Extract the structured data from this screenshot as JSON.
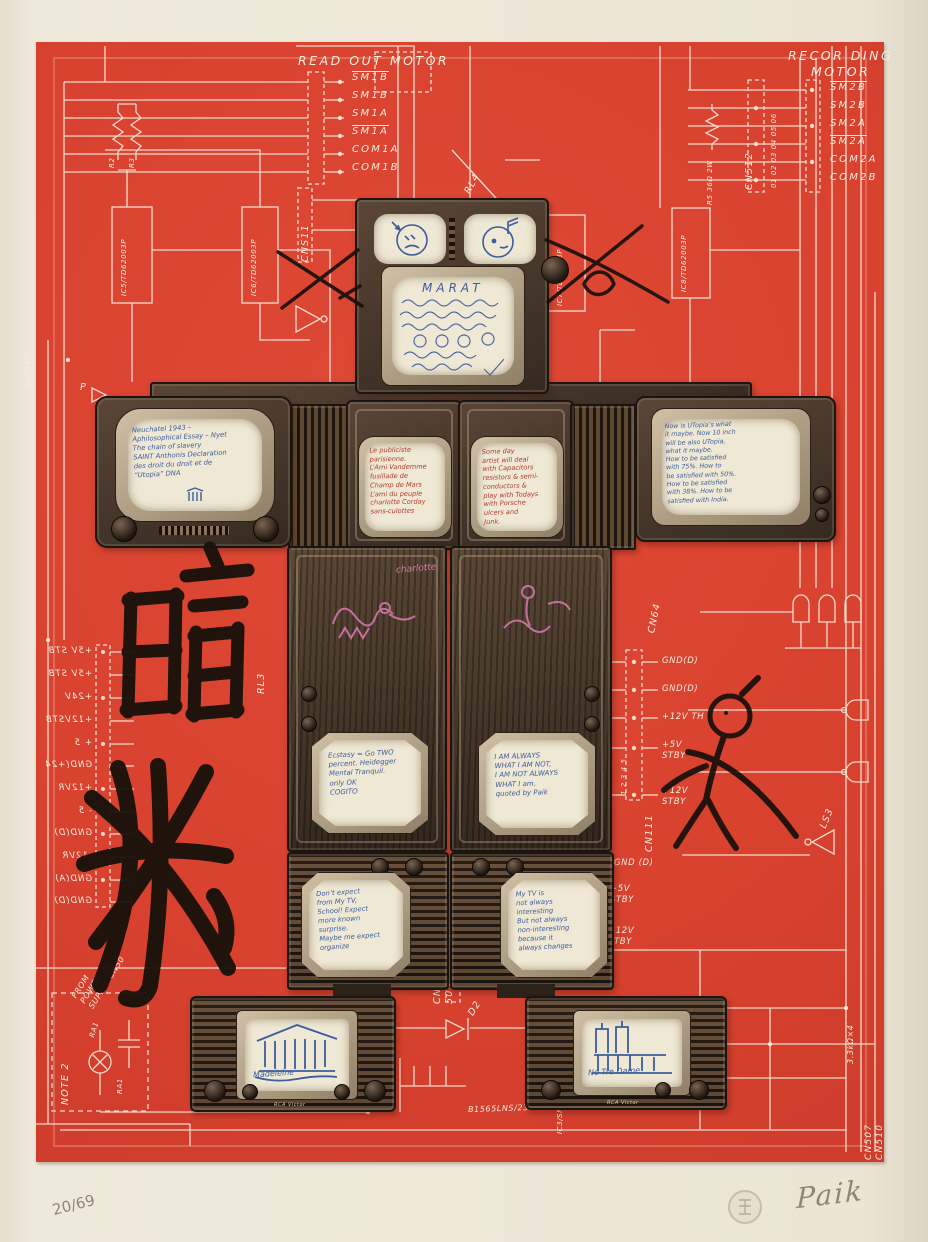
{
  "artwork": {
    "edition_number": "20/69",
    "signature": "Paik",
    "colors": {
      "plate_red": "#d9422f",
      "line_white": "#f6ecdd",
      "ink_blue": "#3d5c9d",
      "ink_red": "#b23a2e",
      "ink_pink": "#d87bb0",
      "brush_black": "#17110b",
      "pencil_gray": "#8e8778",
      "paper": "#efe9db"
    }
  },
  "motors": {
    "readout": {
      "title": "READ OUT MOTOR",
      "pins": [
        "SM1B",
        "SM1B",
        "SM1A",
        "SM1A",
        "COM1A",
        "COM1B"
      ]
    },
    "recording": {
      "title": "RECOR DING\nMOTOR",
      "pins": [
        "SM2B",
        "SM2B",
        "SM2A",
        "SM2A",
        "COM2A",
        "COM2B"
      ]
    }
  },
  "schematic": {
    "cn511": "CNS11",
    "cn512": "CN512",
    "cn512_pins": "01 02 03 04 05 06",
    "cn505": "CN\n505",
    "cn506": "CN506",
    "cn111": "CN111",
    "cn64": "CN64",
    "cn64_pin_numbers": "1 2 3 4 5",
    "cn64_labels": [
      "GND(D)",
      "GND(D)",
      "+12V TH",
      "+5V\nSTBY",
      "+12V\nSTBY"
    ],
    "cn507_cn510": "CN507  CN510",
    "right_lower_labels": [
      "GND (D)",
      "+5V\nSTBY",
      "+12V\nSTBY"
    ],
    "left_rail_labels": [
      "+5V STB",
      "+5V STB",
      "+24V",
      "+12VSTB",
      "+ 5",
      "GND(+24",
      "+12VR",
      "- 5",
      "GND(D)",
      "-12VR",
      "GND(A)",
      "GND(D)"
    ],
    "ic5": "IC5/TD62003P",
    "ic6": "IC6/TD62003P",
    "ic7": "IC7/TD62003P",
    "ic8": "IC8/TD62003P",
    "ic_bottom": "B1565LNS/231",
    "ic3": "IC3/SN5951B",
    "rl3": "RL3",
    "rl4": "RL4",
    "d2": "D2",
    "r2": "R2",
    "r3": "R3",
    "r5_group": "R5  36Ω  2W",
    "r_bottom": "3.3kΩ×4",
    "ra1_lamp": "RA1",
    "ra1_cap": "RA1",
    "note2": "NOTE 2",
    "ls3": "LS3",
    "p_label": "P",
    "plus_24v": "+24V",
    "from_power": "FROM\nPOWER\nSUPPLY CN50"
  },
  "screens": {
    "head_title": "MARAT",
    "head_note": "Korean and Chinese handwriting",
    "left_arm": "Neuchatel 1943 –\nAphilosophical Essay – Nyet\nThe chain of slavery\nSAINT Anthonis Declaration\ndes droit du droit et de\n“Utopia”        DNA",
    "torso_left": "Le publiciste\nparisienne.\nL’Ami Vandemme\nfusillade de\nChamp de Mars\nL’ami du peuple\ncharlotte Corday\nsans-culottes",
    "torso_right": "Some day\nartist will deal\nwith Capacitors\nresistors & semi-\nconductors &\nplay with Todays\nwith Porsche\nulcers and\nJunk.",
    "right_arm": "Now is UTopia’s what\nit maybe.  Now 10 inch\nwill be also UTopia,\nwhat it maybe.\nHow to be satisfied\nwith 75%.  How to\nbe satisfied with 50%.\nHow to be satisfied\nwith 38%.  How to be\nsatisfied with India.",
    "left_knee": "Ecstasy = Go TWO\npercent.  Heidegger\nMental Tranquil.\nonly  OK\nCOGITO",
    "right_knee": "I AM ALWAYS\nWHAT I AM NOT,\nI AM NOT ALWAYS\nWHAT I am.\nquoted by Paik",
    "left_shin": "Don’t expect\nfrom My TV,\nSchool!  Expect\nmore known\nsurprise.\nMaybe me expect\norganize",
    "right_shin": "My TV is\nnot always\ninteresting\nBut not always\nnon-interesting\nbecause it\nalways changes",
    "left_foot_caption": "Madeleine",
    "right_foot_caption": "No Tre Dame",
    "tv_brand": "RCA Victor",
    "pink_word": "charlotte"
  },
  "calligraphy": {
    "top_character": "暗",
    "bottom_character": "殺"
  }
}
